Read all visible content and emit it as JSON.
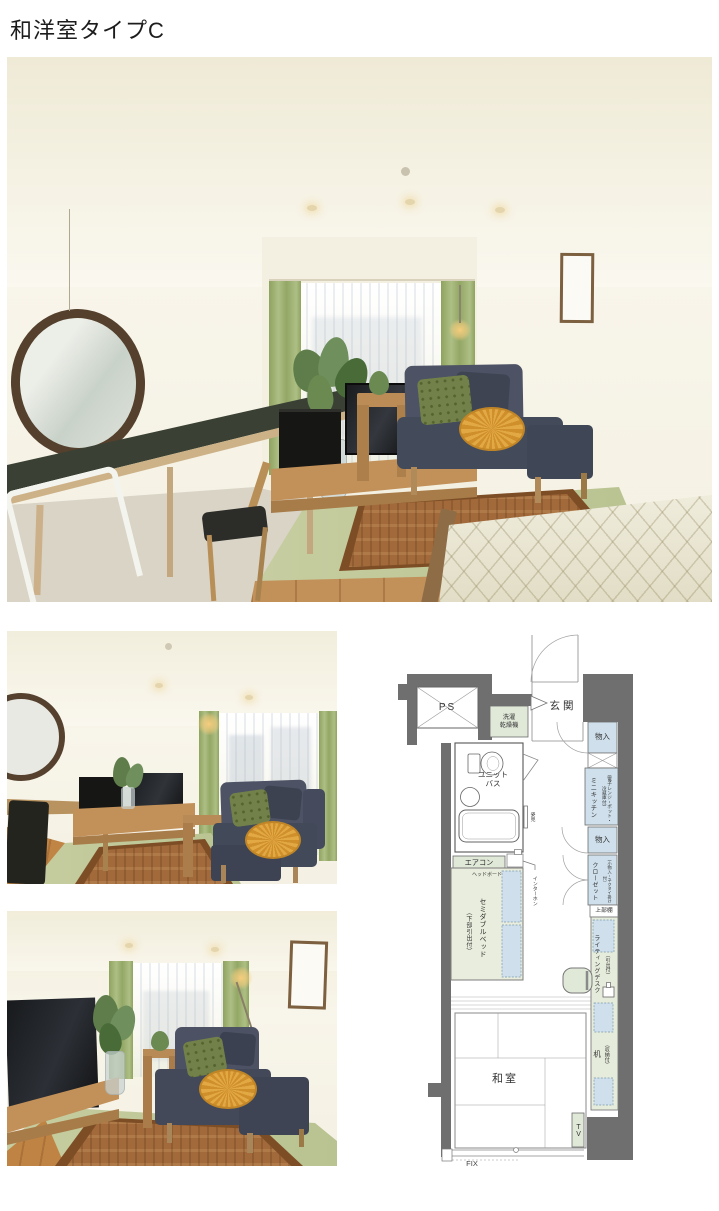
{
  "page": {
    "title": "和洋室タイプC"
  },
  "floorplan": {
    "ps": "PS",
    "washer_dryer": "洗濯\n乾燥機",
    "entrance": "玄関",
    "storage_top": "物入",
    "mini_kitchen": "ミニキッチン",
    "mini_kitchen_note": "（電子レンジ・ポット・冷蔵庫付）",
    "storage_mid": "物入",
    "closet": "クローゼット",
    "closet_note": "（小物入・ネクタイ掛け付）",
    "upper_shelf": "上部棚",
    "writing_desk": "ライティングデスク",
    "writing_desk_note": "（引出付）",
    "desk": "机",
    "desk_note": "（収納付）",
    "unit_bath": "ユニット\nバス",
    "mirror": "姿見",
    "aircon": "エアコン",
    "headboard": "ヘッドボード",
    "intercom": "インターホン",
    "bed": "セミダブルベッド",
    "bed_note": "（下部引出付）",
    "japanese_room": "和室",
    "tv": "TV",
    "fix_window": "FIX"
  },
  "colors": {
    "wall": "#6f6f6f",
    "blue": "#cfe0ec",
    "green": "#e0e8d8",
    "bed": "#e9eddd",
    "tatami": "#c6cda0",
    "rug": "#a2693a",
    "sofa": "#4a5062",
    "orange": "#d9992f",
    "curtain": "#aebf85",
    "wood": "#c29059",
    "carpet": "#d9d4c6",
    "leaf": "#5f7d4b"
  }
}
